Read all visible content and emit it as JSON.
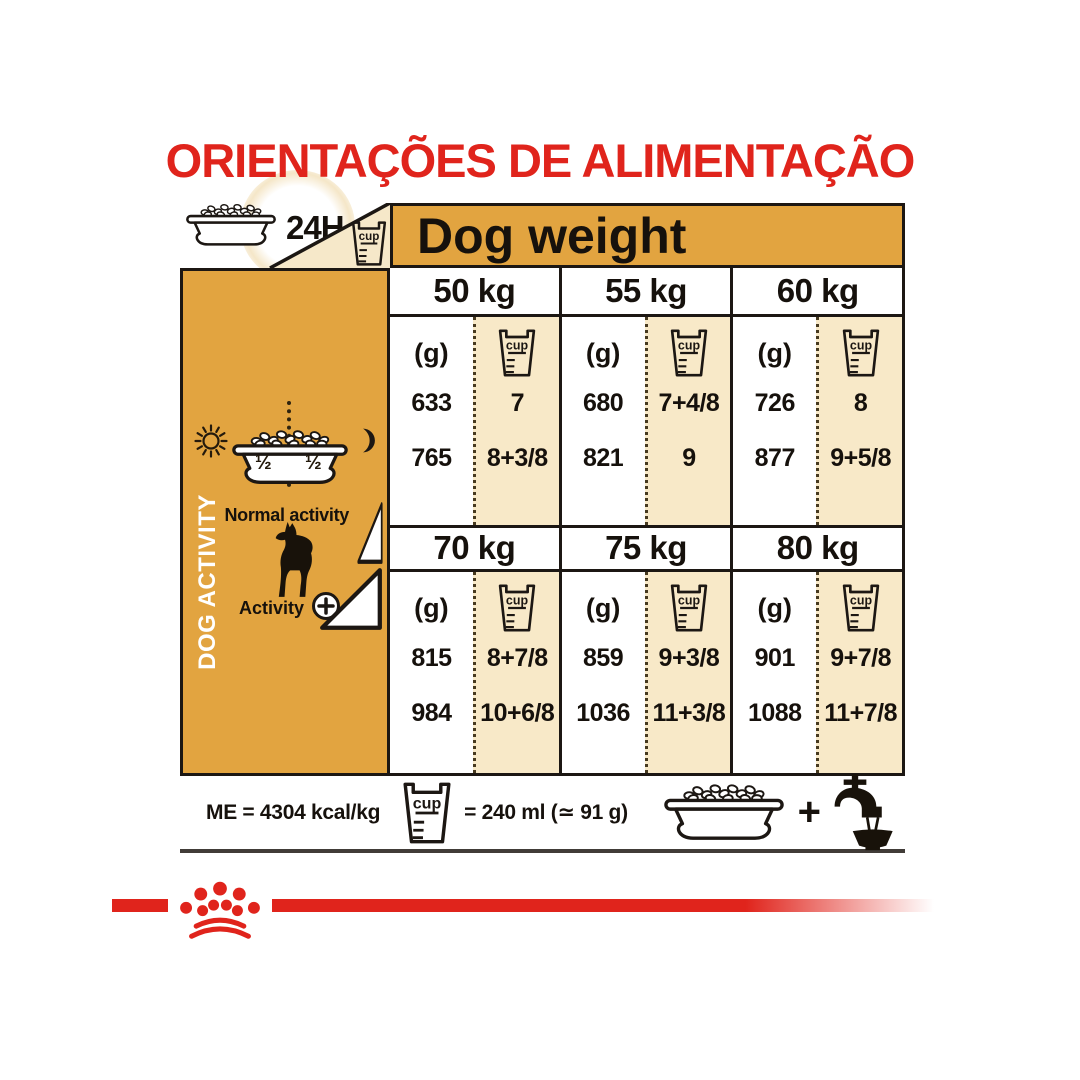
{
  "title": "ORIENTAÇÕES DE ALIMENTAÇÃO",
  "table": {
    "header": "Dog weight",
    "always_label": "24H",
    "cup_label": "cup",
    "unit_g": "(g)",
    "sidebar": {
      "label": "DOG ACTIVITY",
      "half_left": "½",
      "half_right": "½",
      "normal_activity": "Normal activity",
      "activity_label": "Activity"
    },
    "blocks": [
      {
        "columns": [
          {
            "weight": "50 kg",
            "grams": [
              "633",
              "765"
            ],
            "cups": [
              "7",
              "8+3/8"
            ]
          },
          {
            "weight": "55 kg",
            "grams": [
              "680",
              "821"
            ],
            "cups": [
              "7+4/8",
              "9"
            ]
          },
          {
            "weight": "60 kg",
            "grams": [
              "726",
              "877"
            ],
            "cups": [
              "8",
              "9+5/8"
            ]
          }
        ]
      },
      {
        "columns": [
          {
            "weight": "70 kg",
            "grams": [
              "815",
              "984"
            ],
            "cups": [
              "8+7/8",
              "10+6/8"
            ]
          },
          {
            "weight": "75 kg",
            "grams": [
              "859",
              "1036"
            ],
            "cups": [
              "9+3/8",
              "11+3/8"
            ]
          },
          {
            "weight": "80 kg",
            "grams": [
              "901",
              "1088"
            ],
            "cups": [
              "9+7/8",
              "11+7/8"
            ]
          }
        ]
      }
    ]
  },
  "footer": {
    "me_label": "ME = 4304 kcal/kg",
    "cup_equals": "= 240 ml (≃ 91 g)",
    "plus": "+"
  },
  "colors": {
    "brand_red": "#E0241C",
    "gold": "#E2A440",
    "cream": "#F8E9C8",
    "ink": "#1C1713"
  }
}
